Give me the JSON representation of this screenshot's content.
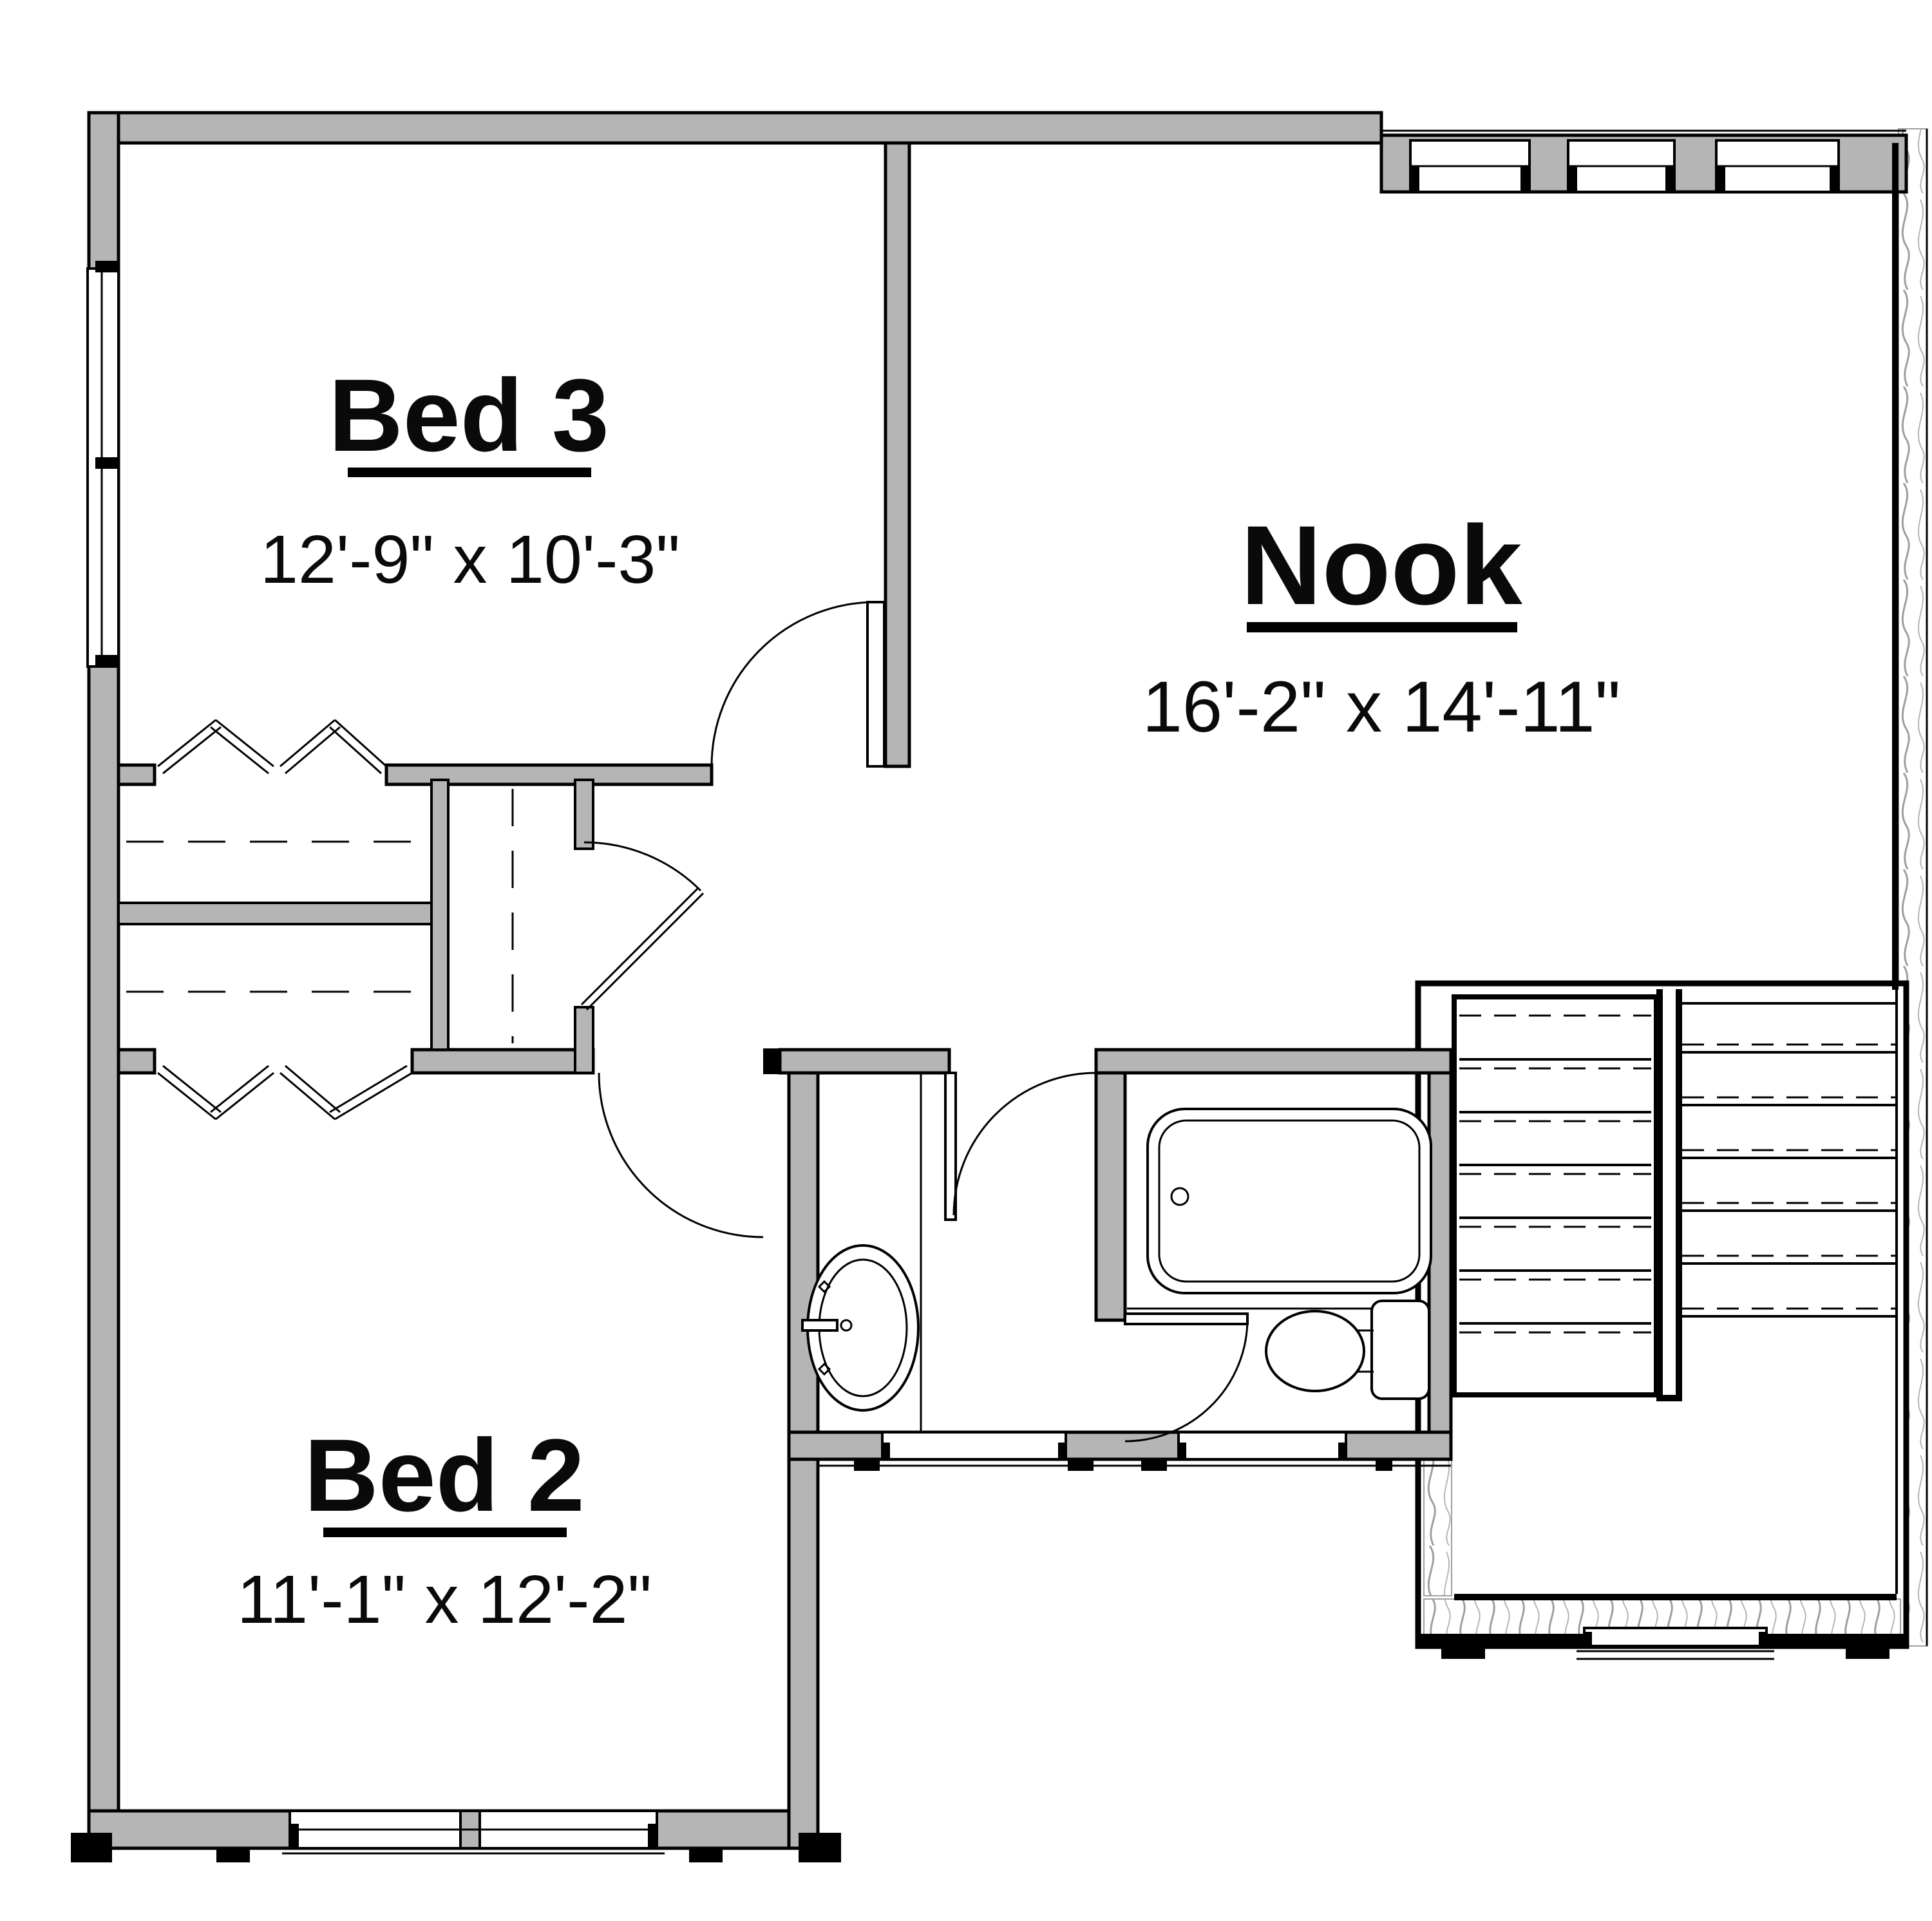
{
  "rooms": {
    "bed3": {
      "name": "Bed 3",
      "dims": "12'-9\" x 10'-3\""
    },
    "nook": {
      "name": "Nook",
      "dims": "16'-2\" x 14'-11\""
    },
    "bed2": {
      "name": "Bed 2",
      "dims": "11'-1\" x 12'-2\""
    }
  },
  "fixtures": {
    "bathtub": "bathtub",
    "toilet": "toilet",
    "sink": "sink-vanity",
    "stairs": "u-shaped-staircase",
    "closet_top": "bifold-closet",
    "closet_bottom": "bifold-closet",
    "linen": "linen-closet"
  },
  "colors": {
    "wall_fill": "#b5b5b5",
    "line": "#000000",
    "hatch": "#9f9f9f",
    "background": "#ffffff"
  }
}
